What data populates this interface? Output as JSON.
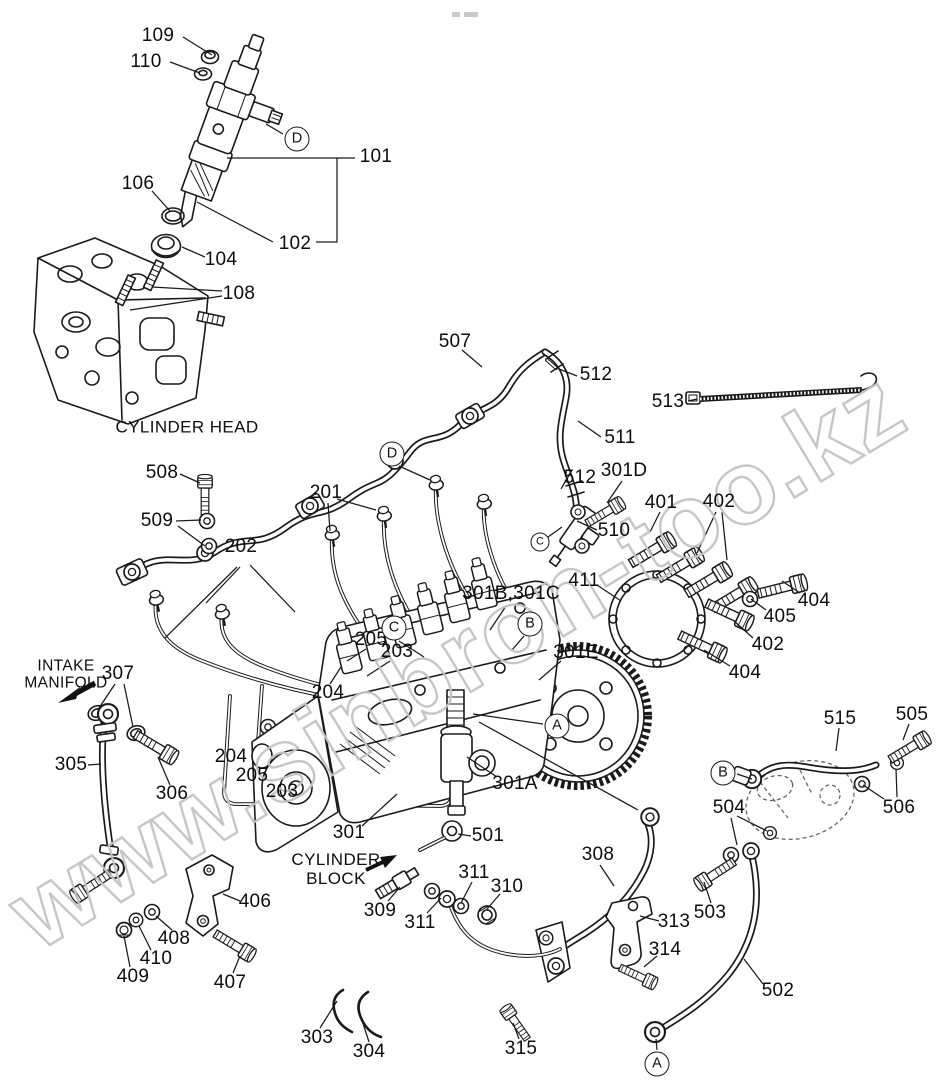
{
  "meta": {
    "bg": "#ffffff",
    "line_color": "#1a1a1a",
    "watermark_color": "#c4c4c4"
  },
  "watermark": {
    "text": "www.sinbron-too.kz"
  },
  "annotations": {
    "cylinder_head": {
      "text": "CYLINDER HEAD"
    },
    "intake_manifold": {
      "line1": "INTAKE",
      "line2": "MANIFOLD"
    },
    "cylinder_block": {
      "line1": "CYLINDER",
      "line2": "BLOCK"
    }
  },
  "balloons": [
    {
      "letter": "D",
      "x": 297,
      "y": 139
    },
    {
      "letter": "D",
      "x": 392,
      "y": 454
    },
    {
      "letter": "C",
      "x": 540,
      "y": 542,
      "small": true
    },
    {
      "letter": "C",
      "x": 394,
      "y": 628
    },
    {
      "letter": "B",
      "x": 530,
      "y": 624
    },
    {
      "letter": "A",
      "x": 557,
      "y": 726
    },
    {
      "letter": "B",
      "x": 723,
      "y": 773
    },
    {
      "letter": "A",
      "x": 657,
      "y": 1064
    }
  ],
  "labels": [
    {
      "text": "109",
      "x": 158,
      "y": 36
    },
    {
      "text": "110",
      "x": 146,
      "y": 62
    },
    {
      "text": "101",
      "x": 376,
      "y": 157
    },
    {
      "text": "102",
      "x": 295,
      "y": 244
    },
    {
      "text": "106",
      "x": 138,
      "y": 184
    },
    {
      "text": "104",
      "x": 221,
      "y": 260
    },
    {
      "text": "108",
      "x": 239,
      "y": 294
    },
    {
      "text": "507",
      "x": 455,
      "y": 342
    },
    {
      "text": "512",
      "x": 596,
      "y": 375
    },
    {
      "text": "513",
      "x": 668,
      "y": 402
    },
    {
      "text": "511",
      "x": 620,
      "y": 438
    },
    {
      "text": "512",
      "x": 580,
      "y": 478
    },
    {
      "text": "301D",
      "x": 624,
      "y": 471
    },
    {
      "text": "401",
      "x": 661,
      "y": 503
    },
    {
      "text": "402",
      "x": 719,
      "y": 502
    },
    {
      "text": "510",
      "x": 614,
      "y": 531
    },
    {
      "text": "411",
      "x": 584,
      "y": 581
    },
    {
      "text": "404",
      "x": 814,
      "y": 601
    },
    {
      "text": "405",
      "x": 780,
      "y": 617
    },
    {
      "text": "402",
      "x": 768,
      "y": 645
    },
    {
      "text": "404",
      "x": 745,
      "y": 673
    },
    {
      "text": "508",
      "x": 162,
      "y": 473
    },
    {
      "text": "509",
      "x": 157,
      "y": 521
    },
    {
      "text": "201",
      "x": 326,
      "y": 493
    },
    {
      "text": "202",
      "x": 241,
      "y": 547
    },
    {
      "text": "301B,301C",
      "x": 511,
      "y": 594
    },
    {
      "text": "301E",
      "x": 576,
      "y": 653
    },
    {
      "text": "205",
      "x": 371,
      "y": 640
    },
    {
      "text": "203",
      "x": 397,
      "y": 652
    },
    {
      "text": "204",
      "x": 328,
      "y": 693
    },
    {
      "text": "307",
      "x": 118,
      "y": 674
    },
    {
      "text": "305",
      "x": 71,
      "y": 765
    },
    {
      "text": "306",
      "x": 172,
      "y": 794
    },
    {
      "text": "204",
      "x": 231,
      "y": 757
    },
    {
      "text": "205",
      "x": 252,
      "y": 776
    },
    {
      "text": "203",
      "x": 282,
      "y": 792
    },
    {
      "text": "301A",
      "x": 515,
      "y": 784
    },
    {
      "text": "301",
      "x": 349,
      "y": 833
    },
    {
      "text": "501",
      "x": 488,
      "y": 836
    },
    {
      "text": "308",
      "x": 598,
      "y": 855
    },
    {
      "text": "515",
      "x": 840,
      "y": 719
    },
    {
      "text": "505",
      "x": 912,
      "y": 715
    },
    {
      "text": "506",
      "x": 899,
      "y": 808
    },
    {
      "text": "504",
      "x": 729,
      "y": 808
    },
    {
      "text": "503",
      "x": 710,
      "y": 913
    },
    {
      "text": "502",
      "x": 778,
      "y": 991
    },
    {
      "text": "406",
      "x": 255,
      "y": 902
    },
    {
      "text": "407",
      "x": 230,
      "y": 983
    },
    {
      "text": "408",
      "x": 174,
      "y": 939
    },
    {
      "text": "410",
      "x": 156,
      "y": 959
    },
    {
      "text": "409",
      "x": 133,
      "y": 977
    },
    {
      "text": "309",
      "x": 380,
      "y": 911
    },
    {
      "text": "311",
      "x": 420,
      "y": 923
    },
    {
      "text": "311",
      "x": 474,
      "y": 873
    },
    {
      "text": "310",
      "x": 507,
      "y": 887
    },
    {
      "text": "313",
      "x": 674,
      "y": 922
    },
    {
      "text": "314",
      "x": 665,
      "y": 950
    },
    {
      "text": "315",
      "x": 521,
      "y": 1049
    },
    {
      "text": "303",
      "x": 317,
      "y": 1038
    },
    {
      "text": "304",
      "x": 369,
      "y": 1052
    }
  ]
}
